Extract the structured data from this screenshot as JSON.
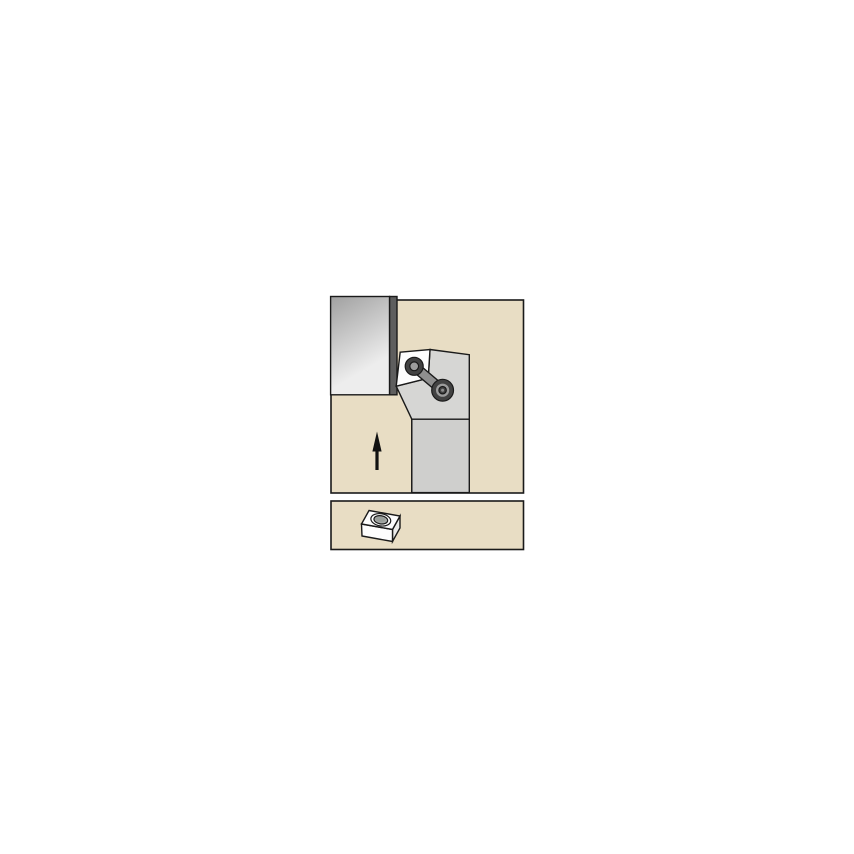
{
  "figure": {
    "description": "Catalog line illustration: lathe turning toolholder with a lever-clamped square insert cutting a workpiece, feed-direction arrow below the workpiece, and a separate detail panel showing the indexable insert with its central hole.",
    "main_view": {
      "components": [
        "workpiece",
        "machined-band",
        "toolholder-head",
        "toolholder-shank",
        "cutting-insert",
        "clamp-lever",
        "insert-screw",
        "pivot-screw",
        "feed-direction-arrow"
      ]
    },
    "detail_view": {
      "components": [
        "indexable-square-insert",
        "center-hole"
      ]
    }
  },
  "colors": {
    "page_background": "#ffffff",
    "panel_fill": "#e8ddc4",
    "outline": "#1a1a1a",
    "workpiece_top": "#a0a0a0",
    "workpiece_bottom": "#ededed",
    "workpiece_band": "#5e5e5e",
    "holder_head": "#d6d6d4",
    "holder_shank": "#cfcfcd",
    "insert_white": "#fdfdfd",
    "insert_right_face": "#ececea",
    "clamp_gray": "#8f8f8f",
    "screw_dark": "#424242",
    "screw_mid": "#9c9c9c",
    "screw_center": "#8d8d8d",
    "hole_gray": "#a4a8a5",
    "hole_shadow": "#8e9390",
    "arrow_black": "#111111"
  }
}
